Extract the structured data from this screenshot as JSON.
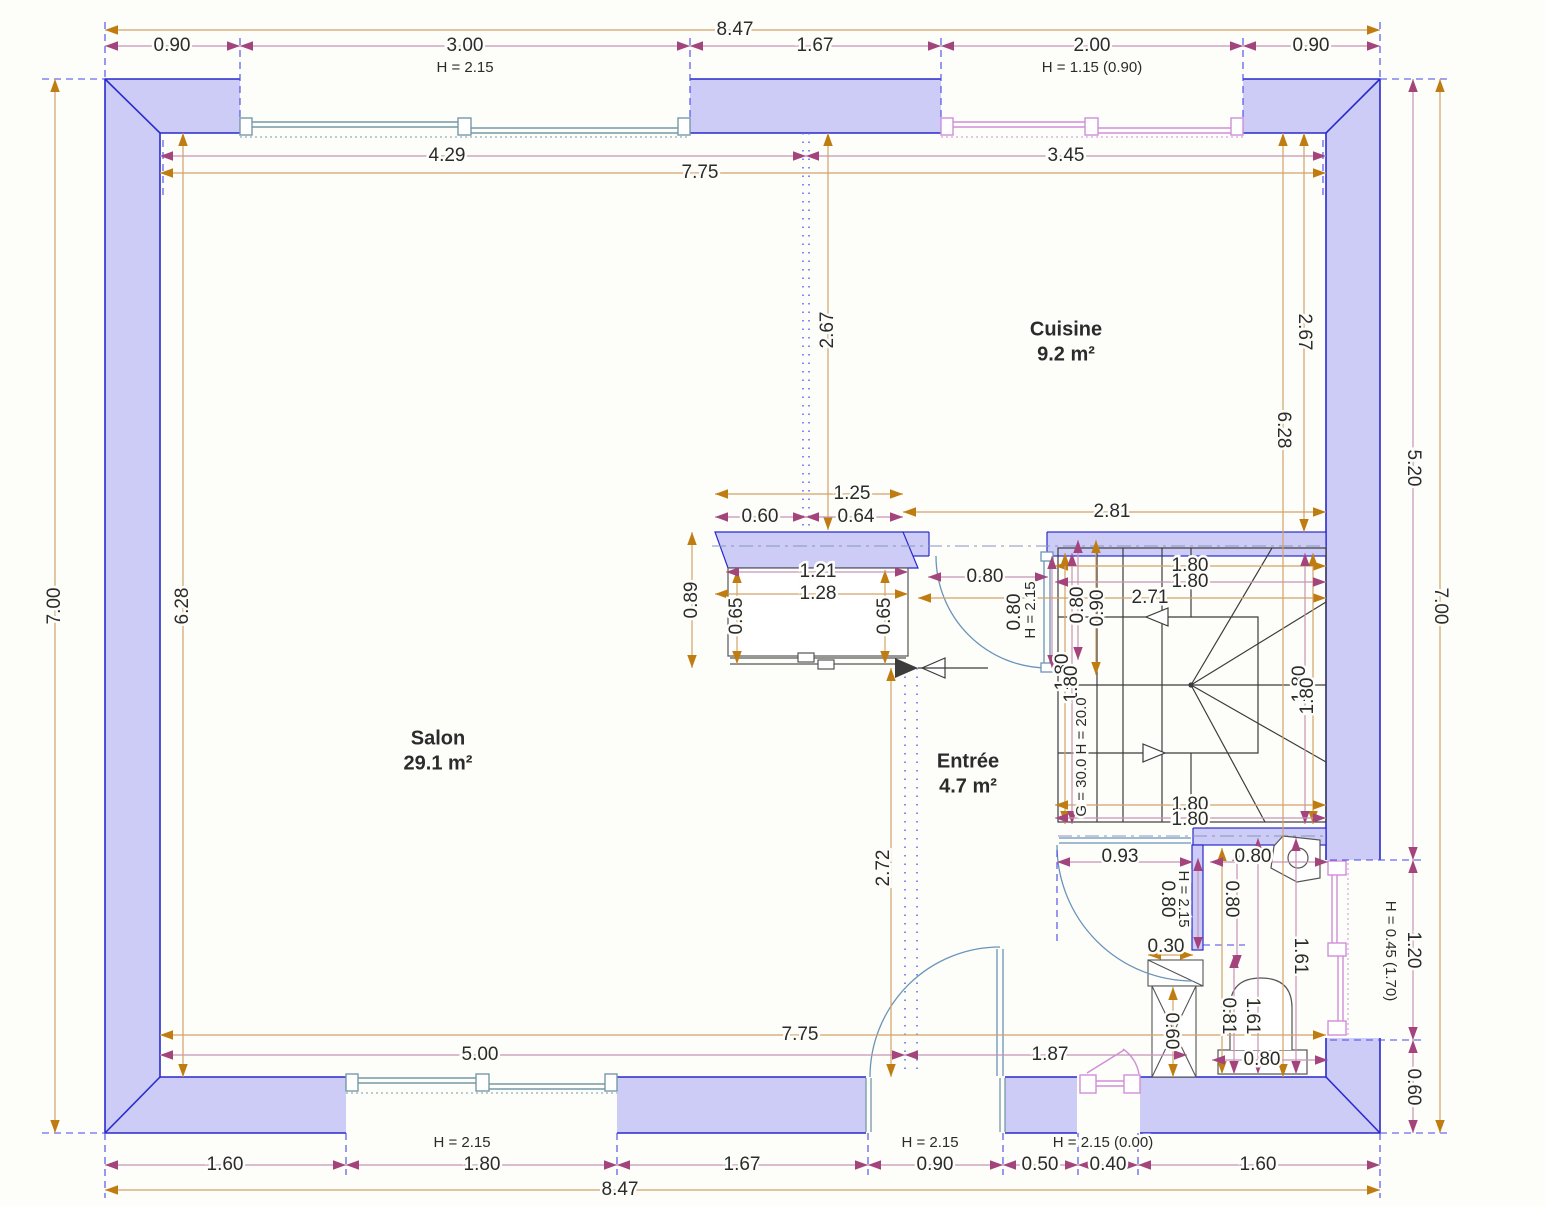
{
  "plan": {
    "rooms": [
      {
        "name": "Cuisine",
        "area": "9.2 m²",
        "x": 1066,
        "y": 330
      },
      {
        "name": "Salon",
        "area": "29.1 m²",
        "x": 438,
        "y": 739
      },
      {
        "name": "Entrée",
        "area": "4.7 m²",
        "x": 968,
        "y": 762
      }
    ],
    "labels": [
      {
        "t": "8.47",
        "x": 735,
        "y": 30,
        "r": 0,
        "s": "d"
      },
      {
        "t": "0.90",
        "x": 172,
        "y": 46,
        "r": 0,
        "s": "d"
      },
      {
        "t": "3.00",
        "x": 465,
        "y": 46,
        "r": 0,
        "s": "d"
      },
      {
        "t": "1.67",
        "x": 815,
        "y": 46,
        "r": 0,
        "s": "d"
      },
      {
        "t": "2.00",
        "x": 1092,
        "y": 46,
        "r": 0,
        "s": "d"
      },
      {
        "t": "0.90",
        "x": 1311,
        "y": 46,
        "r": 0,
        "s": "d"
      },
      {
        "t": "H = 2.15",
        "x": 465,
        "y": 68,
        "r": 0,
        "s": "n"
      },
      {
        "t": "H = 1.15 (0.90)",
        "x": 1092,
        "y": 68,
        "r": 0,
        "s": "n"
      },
      {
        "t": "4.29",
        "x": 447,
        "y": 156,
        "r": 0,
        "s": "d"
      },
      {
        "t": "3.45",
        "x": 1066,
        "y": 156,
        "r": 0,
        "s": "d"
      },
      {
        "t": "7.75",
        "x": 700,
        "y": 173,
        "r": 0,
        "s": "d"
      },
      {
        "t": "7.00",
        "x": 55,
        "y": 606,
        "r": -90,
        "s": "d"
      },
      {
        "t": "6.28",
        "x": 183,
        "y": 606,
        "r": -90,
        "s": "d"
      },
      {
        "t": "2.67",
        "x": 828,
        "y": 330,
        "r": -90,
        "s": "d"
      },
      {
        "t": "2.67",
        "x": 1304,
        "y": 332,
        "r": 90,
        "s": "d"
      },
      {
        "t": "6.28",
        "x": 1283,
        "y": 430,
        "r": 90,
        "s": "d"
      },
      {
        "t": "5.20",
        "x": 1413,
        "y": 468,
        "r": 90,
        "s": "d"
      },
      {
        "t": "1.20",
        "x": 1413,
        "y": 950,
        "r": 90,
        "s": "d"
      },
      {
        "t": "H = 0.45 (1.70)",
        "x": 1390,
        "y": 951,
        "r": 90,
        "s": "n"
      },
      {
        "t": "0.60",
        "x": 1413,
        "y": 1087,
        "r": 90,
        "s": "d"
      },
      {
        "t": "7.00",
        "x": 1440,
        "y": 606,
        "r": 90,
        "s": "d"
      },
      {
        "t": "1.25",
        "x": 852,
        "y": 494,
        "r": 0,
        "s": "d"
      },
      {
        "t": "0.60",
        "x": 760,
        "y": 517,
        "r": 0,
        "s": "d"
      },
      {
        "t": "0.64",
        "x": 856,
        "y": 517,
        "r": 0,
        "s": "d"
      },
      {
        "t": "0.89",
        "x": 692,
        "y": 600,
        "r": -90,
        "s": "d"
      },
      {
        "t": "1.21",
        "x": 818,
        "y": 572,
        "r": 0,
        "s": "d"
      },
      {
        "t": "1.28",
        "x": 818,
        "y": 594,
        "r": 0,
        "s": "d"
      },
      {
        "t": "0.65",
        "x": 737,
        "y": 616,
        "r": -90,
        "s": "d"
      },
      {
        "t": "0.65",
        "x": 885,
        "y": 616,
        "r": -90,
        "s": "d"
      },
      {
        "t": "0.80",
        "x": 985,
        "y": 577,
        "r": 0,
        "s": "d"
      },
      {
        "t": "0.80",
        "x": 1015,
        "y": 612,
        "r": -90,
        "s": "d"
      },
      {
        "t": "H = 2.15",
        "x": 1031,
        "y": 610,
        "r": -90,
        "s": "n"
      },
      {
        "t": "2.81",
        "x": 1112,
        "y": 512,
        "r": 0,
        "s": "d"
      },
      {
        "t": "1.80",
        "x": 1190,
        "y": 566,
        "r": 0,
        "s": "d"
      },
      {
        "t": "1.80",
        "x": 1190,
        "y": 582,
        "r": 0,
        "s": "d"
      },
      {
        "t": "2.71",
        "x": 1150,
        "y": 598,
        "r": 0,
        "s": "d"
      },
      {
        "t": "0.80",
        "x": 1078,
        "y": 605,
        "r": -90,
        "s": "d"
      },
      {
        "t": "0.90",
        "x": 1098,
        "y": 608,
        "r": -90,
        "s": "d"
      },
      {
        "t": "1.80",
        "x": 1063,
        "y": 672,
        "r": -90,
        "s": "d"
      },
      {
        "t": "1.80",
        "x": 1072,
        "y": 684,
        "r": -90,
        "s": "d"
      },
      {
        "t": "G = 30.0  H = 20.0",
        "x": 1082,
        "y": 757,
        "r": -90,
        "s": "n"
      },
      {
        "t": "1.80",
        "x": 1300,
        "y": 684,
        "r": -90,
        "s": "d"
      },
      {
        "t": "1.80",
        "x": 1308,
        "y": 696,
        "r": -90,
        "s": "d"
      },
      {
        "t": "1.80",
        "x": 1190,
        "y": 805,
        "r": 0,
        "s": "d"
      },
      {
        "t": "1.80",
        "x": 1190,
        "y": 820,
        "r": 0,
        "s": "d"
      },
      {
        "t": "0.93",
        "x": 1120,
        "y": 857,
        "r": 0,
        "s": "d"
      },
      {
        "t": "0.80",
        "x": 1253,
        "y": 857,
        "r": 0,
        "s": "d"
      },
      {
        "t": "0.80",
        "x": 1167,
        "y": 899,
        "r": 90,
        "s": "d"
      },
      {
        "t": "H = 2.15",
        "x": 1183,
        "y": 899,
        "r": 90,
        "s": "n"
      },
      {
        "t": "0.30",
        "x": 1166,
        "y": 947,
        "r": 0,
        "s": "d"
      },
      {
        "t": "0.80",
        "x": 1231,
        "y": 899,
        "r": 90,
        "s": "d"
      },
      {
        "t": "1.61",
        "x": 1300,
        "y": 956,
        "r": 90,
        "s": "d"
      },
      {
        "t": "1.61",
        "x": 1252,
        "y": 1016,
        "r": 90,
        "s": "d"
      },
      {
        "t": "0.81",
        "x": 1228,
        "y": 1016,
        "r": 90,
        "s": "d"
      },
      {
        "t": "0.60",
        "x": 1171,
        "y": 1031,
        "r": 90,
        "s": "d"
      },
      {
        "t": "0.80",
        "x": 1262,
        "y": 1060,
        "r": 0,
        "s": "d"
      },
      {
        "t": "7.75",
        "x": 800,
        "y": 1035,
        "r": 0,
        "s": "d"
      },
      {
        "t": "5.00",
        "x": 480,
        "y": 1055,
        "r": 0,
        "s": "d"
      },
      {
        "t": "1.87",
        "x": 1050,
        "y": 1055,
        "r": 0,
        "s": "d"
      },
      {
        "t": "2.72",
        "x": 884,
        "y": 868,
        "r": -90,
        "s": "d"
      },
      {
        "t": "H = 2.15",
        "x": 462,
        "y": 1143,
        "r": 0,
        "s": "n"
      },
      {
        "t": "H = 2.15",
        "x": 930,
        "y": 1143,
        "r": 0,
        "s": "n"
      },
      {
        "t": "H = 2.15 (0.00)",
        "x": 1103,
        "y": 1143,
        "r": 0,
        "s": "n"
      },
      {
        "t": "1.60",
        "x": 225,
        "y": 1165,
        "r": 0,
        "s": "d"
      },
      {
        "t": "1.80",
        "x": 482,
        "y": 1165,
        "r": 0,
        "s": "d"
      },
      {
        "t": "1.67",
        "x": 742,
        "y": 1165,
        "r": 0,
        "s": "d"
      },
      {
        "t": "0.90",
        "x": 935,
        "y": 1165,
        "r": 0,
        "s": "d"
      },
      {
        "t": "0.50",
        "x": 1040,
        "y": 1165,
        "r": 0,
        "s": "d"
      },
      {
        "t": "0.40",
        "x": 1108,
        "y": 1165,
        "r": 0,
        "s": "d"
      },
      {
        "t": "1.60",
        "x": 1258,
        "y": 1165,
        "r": 0,
        "s": "d"
      },
      {
        "t": "8.47",
        "x": 620,
        "y": 1190,
        "r": 0,
        "s": "d"
      }
    ],
    "colors": {
      "wall_fill": "#ccccf6",
      "wall_stroke": "#2a2acd",
      "dim_orange_line": "#d2a368",
      "dim_orange_arrow": "#bf7c10",
      "dim_magenta_line": "#c795b3",
      "dim_magenta_arrow": "#a3457c",
      "window_teal": "#7699a8",
      "window_pink": "#cf8ed8",
      "stairs": "#3c3c3c",
      "extension_blue": "#4747ea",
      "text": "#2b2b2b"
    }
  }
}
